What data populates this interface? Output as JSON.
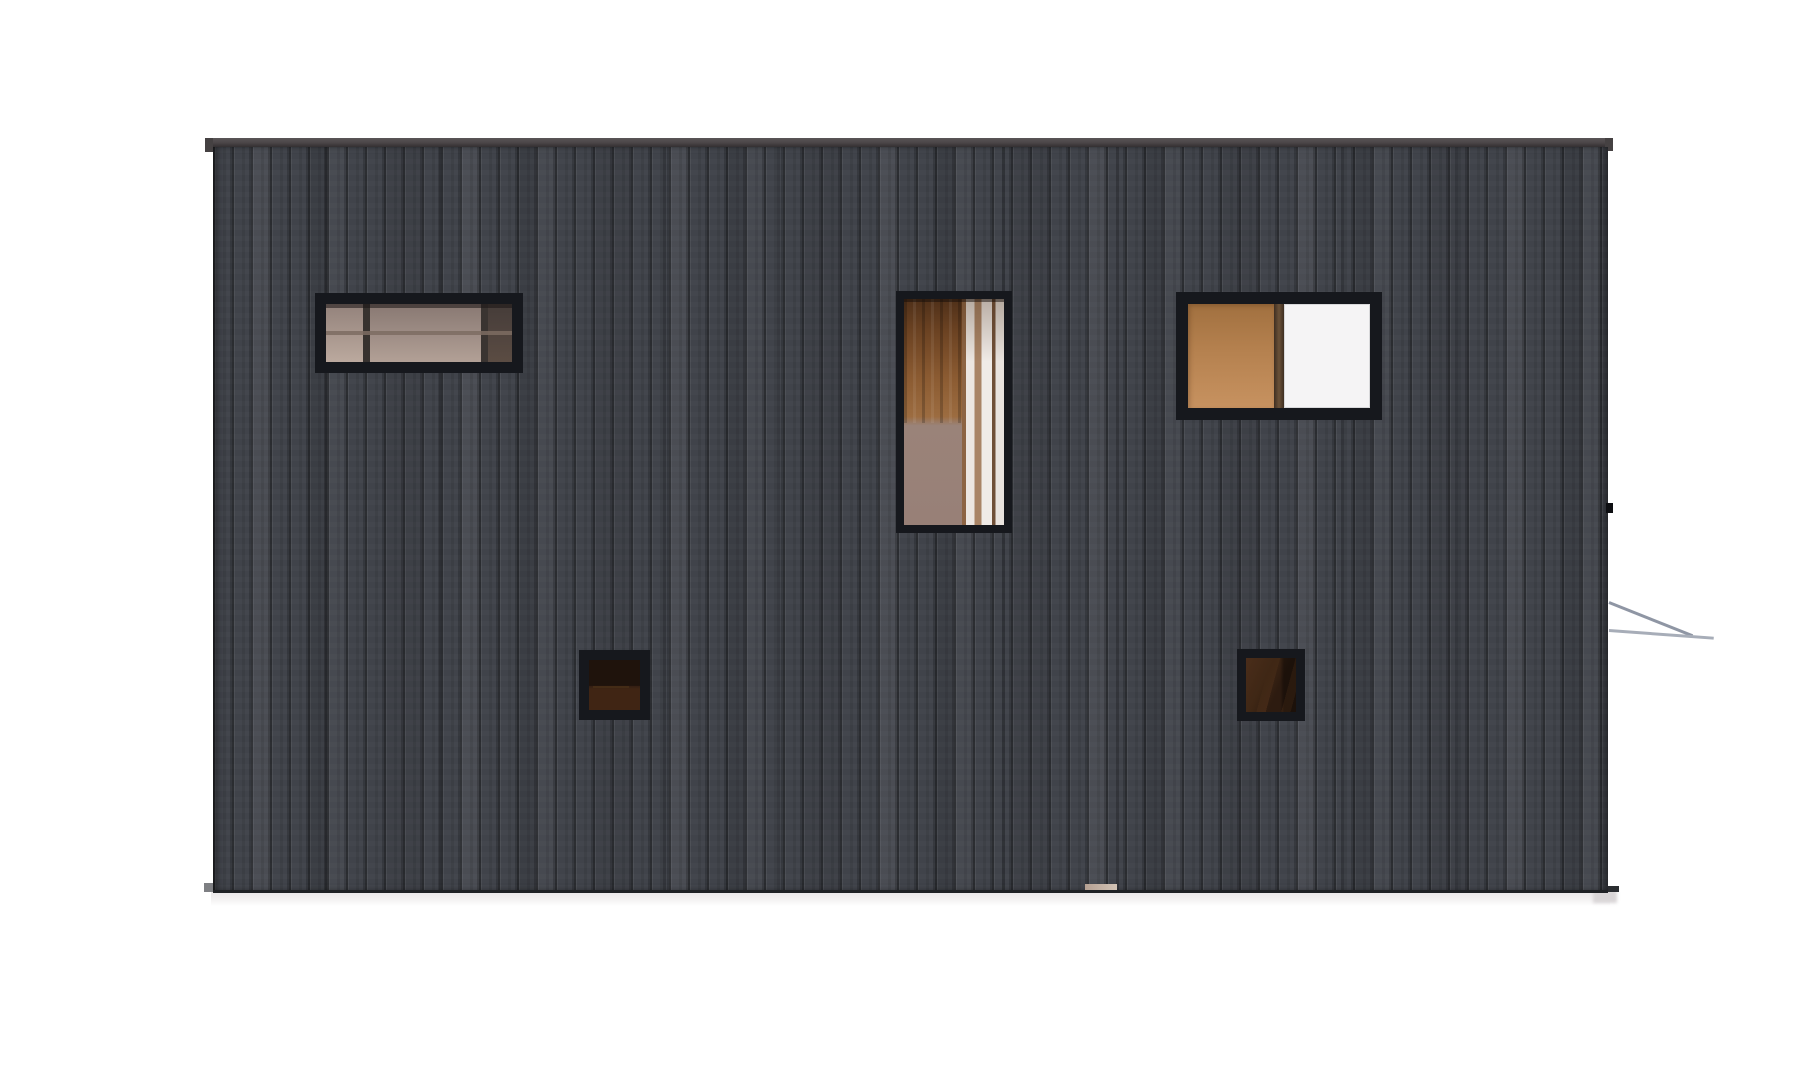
{
  "scene": {
    "type": "architectural-elevation-render",
    "subject": "side elevation of a flat-roofed building clad in dark vertical timber siding",
    "background": "plain white page, soft gray ground shadow under the slab",
    "building": {
      "cladding": "charred-black vertical wood planks, ~19px board width, full height",
      "roof": "thin dark gray fascia cap slightly overhanging both ends",
      "ground_line": "dark base edge with small gray foundation stub at left and dark stub at right corner",
      "threshold_sliver": "small light-tan floor-edge sliver visible at base near center-right"
    },
    "windows": [
      {
        "id": "clerestory-left",
        "shape": "wide horizontal",
        "frame": "thick near-black",
        "interior": "warm taupe glazing with interior frame grid (two vertical bars, one horizontal bar), darker at right"
      },
      {
        "id": "tall-center",
        "shape": "tall vertical",
        "frame": "thick near-black",
        "interior": "orange-brown wood slats upper left, mauve wall lower left, white-and-brown curtain folds at right"
      },
      {
        "id": "upper-right",
        "shape": "wide horizontal",
        "frame": "thick near-black",
        "interior": "terracotta-tan pane on left, dark brown mullion, bright white pane on right"
      },
      {
        "id": "small-lower-left",
        "shape": "small square",
        "frame": "near-black",
        "interior": "very dark brown room with faint furniture edge"
      },
      {
        "id": "small-lower-right",
        "shape": "small square",
        "frame": "near-black",
        "interior": "dark brown room with diagonal lighter shapes"
      }
    ],
    "right_side_details": [
      "small black wall bracket on right edge",
      "two thin gray handrail lines (one diagonal, one near-horizontal) projecting right"
    ]
  },
  "colors": {
    "background": "#ffffff",
    "siding-base": "#41444b",
    "roof": "#4a4547",
    "frame": "#16181d",
    "tan-top": "#a1703f",
    "tan-mid": "#b5814f",
    "tan-bottom": "#c79260",
    "white-pane": "#f5f4f5",
    "rail": "#a7adb8",
    "rail-dark": "#8f96a4",
    "shadow": "#e8e4e6"
  }
}
